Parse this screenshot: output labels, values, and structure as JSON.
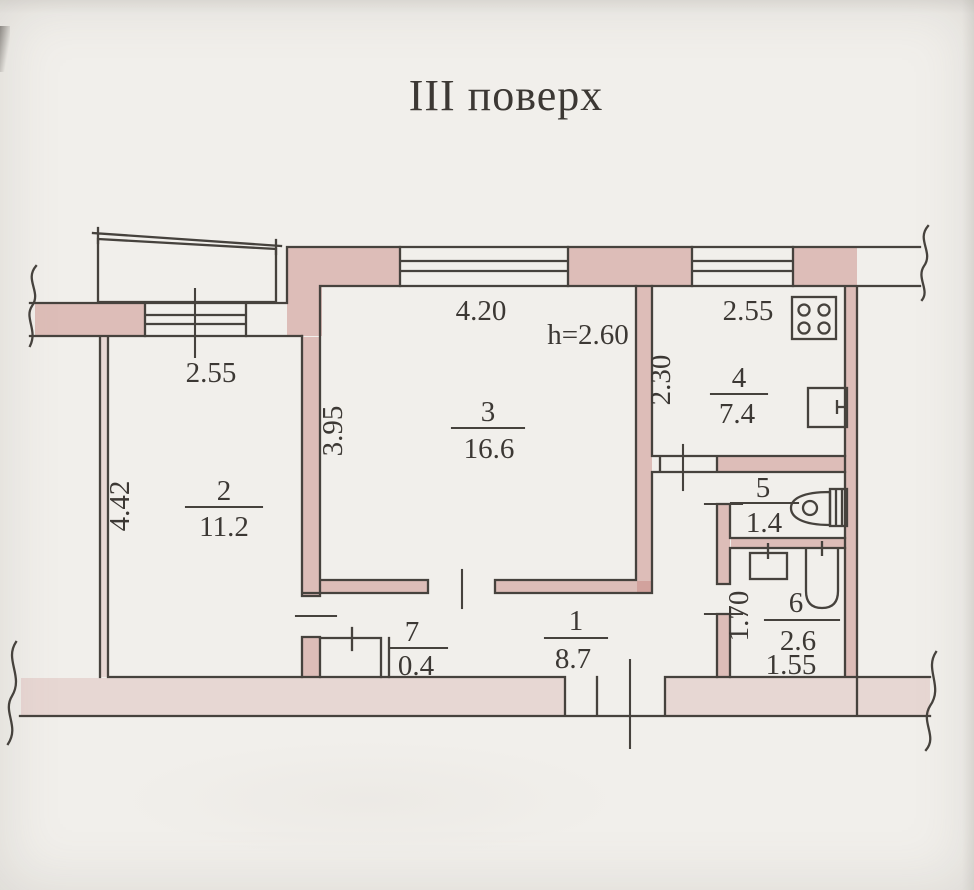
{
  "title": "III поверх",
  "rooms": {
    "r1": {
      "number": "1",
      "area": "8.7"
    },
    "r2": {
      "number": "2",
      "area": "11.2"
    },
    "r3": {
      "number": "3",
      "area": "16.6"
    },
    "r4": {
      "number": "4",
      "area": "7.4"
    },
    "r5": {
      "number": "5",
      "area": "1.4"
    },
    "r6": {
      "number": "6",
      "area": "2.6"
    },
    "r7": {
      "number": "7",
      "area": "0.4"
    }
  },
  "dimensions": {
    "room2_window_width": "2.55",
    "room2_depth": "4.42",
    "room3_width": "4.20",
    "room3_depth": "3.95",
    "ceiling_height": "h=2.60",
    "kitchen_window_width": "2.55",
    "kitchen_depth": "2.30",
    "bathroom_depth": "1.70",
    "bathroom_width": "1.55"
  },
  "fixtures": {
    "stove": "stove-icon",
    "kitchen_sink": "kitchen-sink-icon",
    "toilet": "toilet-icon",
    "wash_basin": "wash-basin-icon",
    "bathtub": "bathtub-icon"
  },
  "colors": {
    "paper": "#f1efeb",
    "line": "#46423d",
    "wall_fill": "#c78580",
    "wall_fill_light": "#d2a09a"
  }
}
